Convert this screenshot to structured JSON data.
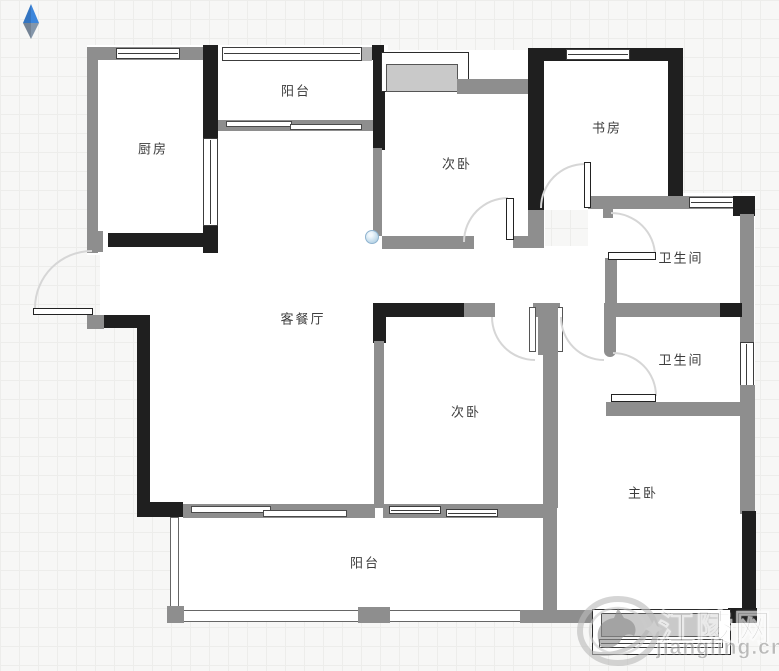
{
  "plan": {
    "type": "apartment-floor-plan",
    "rooms": [
      {
        "id": "kitchen",
        "label": "厨房"
      },
      {
        "id": "balcony-top",
        "label": "阳台"
      },
      {
        "id": "bedroom-top",
        "label": "次卧"
      },
      {
        "id": "study",
        "label": "书房"
      },
      {
        "id": "bathroom-1",
        "label": "卫生间"
      },
      {
        "id": "bathroom-2",
        "label": "卫生间"
      },
      {
        "id": "living-dining",
        "label": "客餐厅"
      },
      {
        "id": "bedroom-bottom",
        "label": "次卧"
      },
      {
        "id": "master-bedroom",
        "label": "主卧"
      },
      {
        "id": "balcony-bottom",
        "label": "阳台"
      }
    ]
  },
  "watermark": {
    "site_name": "江陵网",
    "site_url": "jiangling.cn"
  },
  "colors": {
    "wall_dark": "#1f1f1f",
    "wall_gray": "#8e8e8e",
    "bay_sill_fill": "#c9c9c9",
    "compass_blue": "#3c86dc",
    "compass_gray_blue": "#8496aa",
    "vertex_handle_blue": "#bcd7e8",
    "grid_line": "#ededeb",
    "background": "#f7f7f6"
  }
}
